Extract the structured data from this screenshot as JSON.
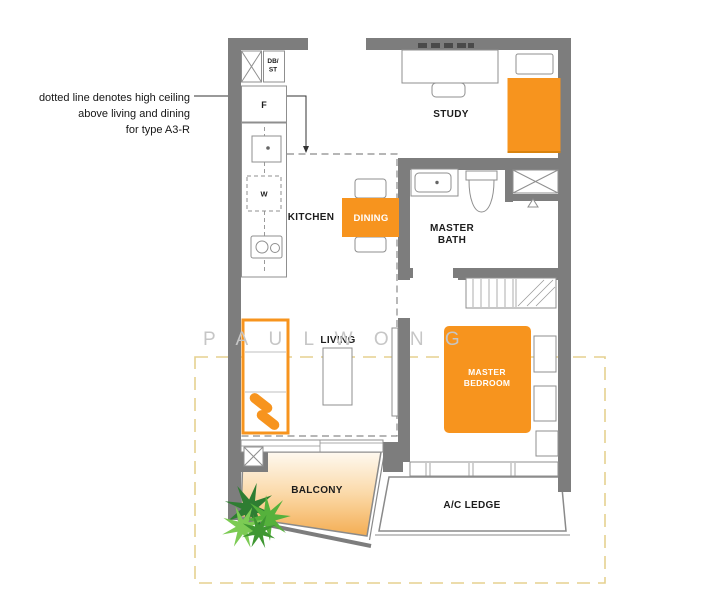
{
  "annotation": {
    "line1": "dotted line denotes high ceiling",
    "line2": "above living and dining",
    "line3": "for type A3-R"
  },
  "watermark": "P A U L   W O N G",
  "rooms": {
    "study": "STUDY",
    "kitchen": "KITCHEN",
    "dining": "DINING",
    "master_bath_line1": "MASTER",
    "master_bath_line2": "BATH",
    "living": "LIVING",
    "master_bedroom_line1": "MASTER",
    "master_bedroom_line2": "BEDROOM",
    "balcony": "BALCONY",
    "ac_ledge": "A/C LEDGE"
  },
  "fixtures": {
    "shaft_line1": "DB/",
    "shaft_line2": "ST",
    "fridge": "F",
    "washer": "W"
  },
  "colors": {
    "accent_orange": "#F7941E",
    "wall_gray": "#7D7D7D",
    "line_gray": "#8F8F8F",
    "boundary_dash_yellow": "#E5D18F",
    "watermark_gray": "#C6C6C6",
    "balcony_gradient_start": "#FEF9F0",
    "balcony_gradient_end": "#F2A440",
    "plant_green_dark": "#2E7D32",
    "plant_green_mid": "#55B13C",
    "plant_green_light": "#7CCB54"
  }
}
